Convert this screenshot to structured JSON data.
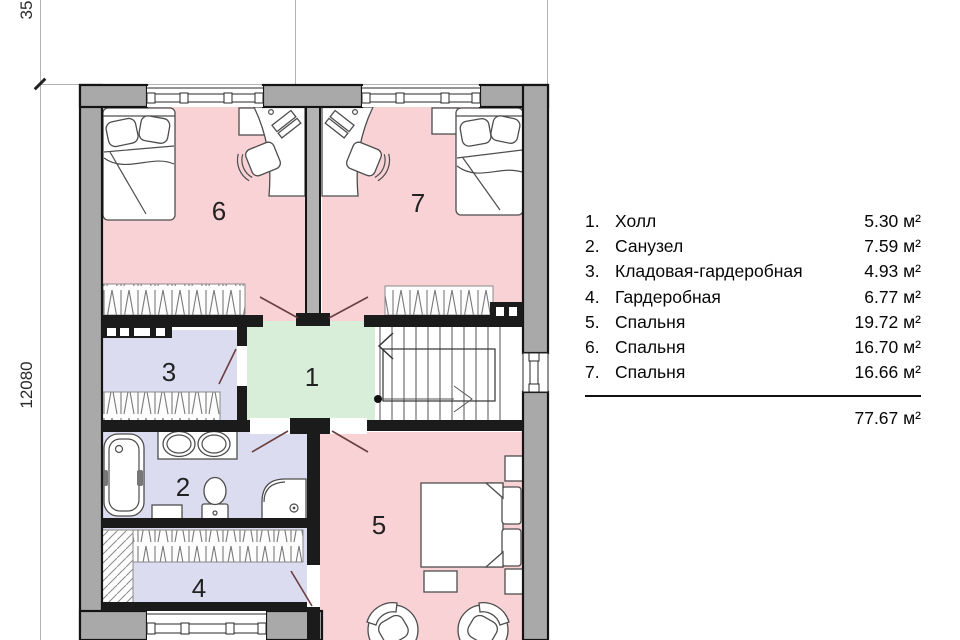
{
  "plan": {
    "dim_left": "12080",
    "dim_top": "35",
    "rooms": [
      {
        "number": "1"
      },
      {
        "number": "2"
      },
      {
        "number": "3"
      },
      {
        "number": "4"
      },
      {
        "number": "5"
      },
      {
        "number": "6"
      },
      {
        "number": "7"
      }
    ]
  },
  "legend": {
    "items": [
      {
        "num": "1.",
        "name": "Холл",
        "area": "5.30 м²"
      },
      {
        "num": "2.",
        "name": "Санузел",
        "area": "7.59 м²"
      },
      {
        "num": "3.",
        "name": "Кладовая-гардеробная",
        "area": "4.93 м²"
      },
      {
        "num": "4.",
        "name": "Гардеробная",
        "area": "6.77 м²"
      },
      {
        "num": "5.",
        "name": "Спальня",
        "area": "19.72 м²"
      },
      {
        "num": "6.",
        "name": "Спальня",
        "area": "16.70 м²"
      },
      {
        "num": "7.",
        "name": "Спальня",
        "area": "16.66 м²"
      }
    ],
    "total": "77.67 м²"
  },
  "colors": {
    "bedroom_pink": "#f8d2d5",
    "wet_room_lavender": "#dcdcf1",
    "hall_green": "#d8eed8",
    "wall_gray": "#a9a9a9",
    "wall_dark": "#1b1b1b",
    "door_swing": "#6b3f3f"
  }
}
